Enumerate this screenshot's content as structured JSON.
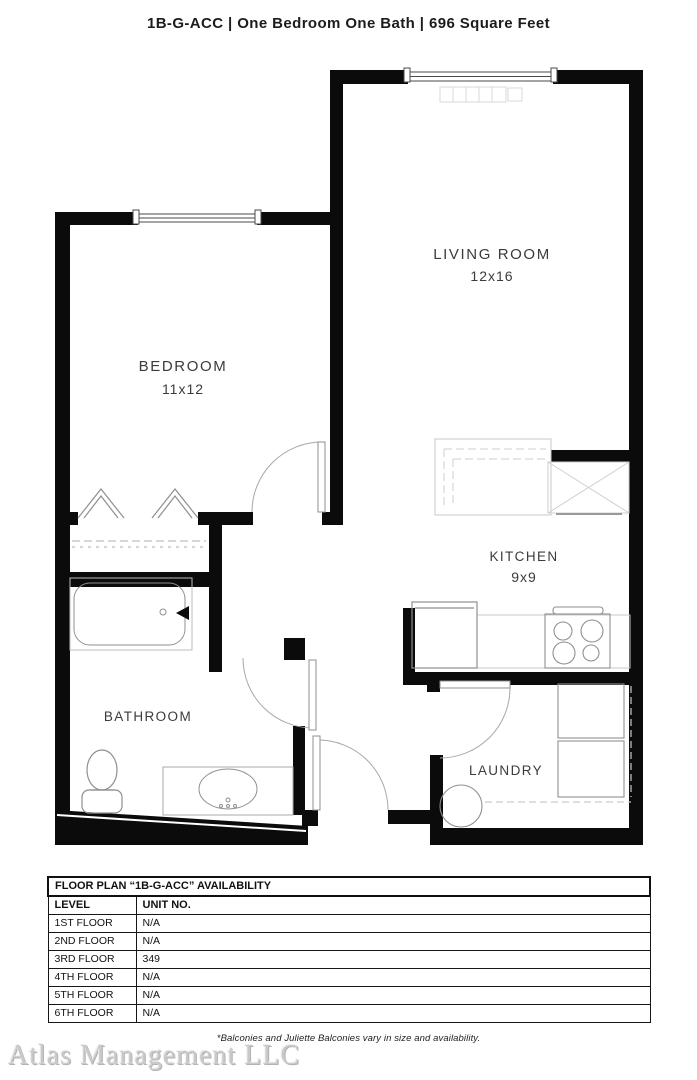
{
  "header": {
    "title": "1B-G-ACC  |  One Bedroom One Bath  |  696 Square Feet",
    "unit_code": "1B-G-ACC",
    "unit_type": "One Bedroom One Bath",
    "square_feet": "696 Square Feet",
    "separator": "|"
  },
  "floor_plan": {
    "rooms": [
      {
        "name": "LIVING ROOM",
        "dims": "12x16"
      },
      {
        "name": "BEDROOM",
        "dims": "11x12"
      },
      {
        "name": "KITCHEN",
        "dims": "9x9"
      },
      {
        "name": "BATHROOM"
      },
      {
        "name": "LAUNDRY"
      }
    ],
    "fixtures": [
      "living-room-window",
      "bedroom-window",
      "baseboard-heater",
      "kitchen-island",
      "cabinet-x-box",
      "refrigerator",
      "stove",
      "counter",
      "washer",
      "dryer",
      "water-heater",
      "bathtub",
      "tub-faucet",
      "toilet",
      "vanity-sink",
      "closet-hangers",
      "closet-shelf",
      "bedroom-door",
      "bathroom-door",
      "entry-door",
      "laundry-door"
    ]
  },
  "availability_table": {
    "title": "FLOOR PLAN “1B-G-ACC” AVAILABILITY",
    "columns": [
      "LEVEL",
      "UNIT NO."
    ],
    "rows": [
      [
        "1ST FLOOR",
        "N/A"
      ],
      [
        "2ND FLOOR",
        "N/A"
      ],
      [
        "3RD FLOOR",
        "349"
      ],
      [
        "4TH FLOOR",
        "N/A"
      ],
      [
        "5TH FLOOR",
        "N/A"
      ],
      [
        "6TH FLOOR",
        "N/A"
      ]
    ]
  },
  "footnote": "*Balconies and Juliette Balconies vary in size and availability.",
  "watermark": "Atlas Management LLC",
  "colors": {
    "wall": "#0b0b0b",
    "fixture_line": "#8f8f8f",
    "light_line": "#c9c9c9",
    "label_text": "#3b3b3b"
  }
}
